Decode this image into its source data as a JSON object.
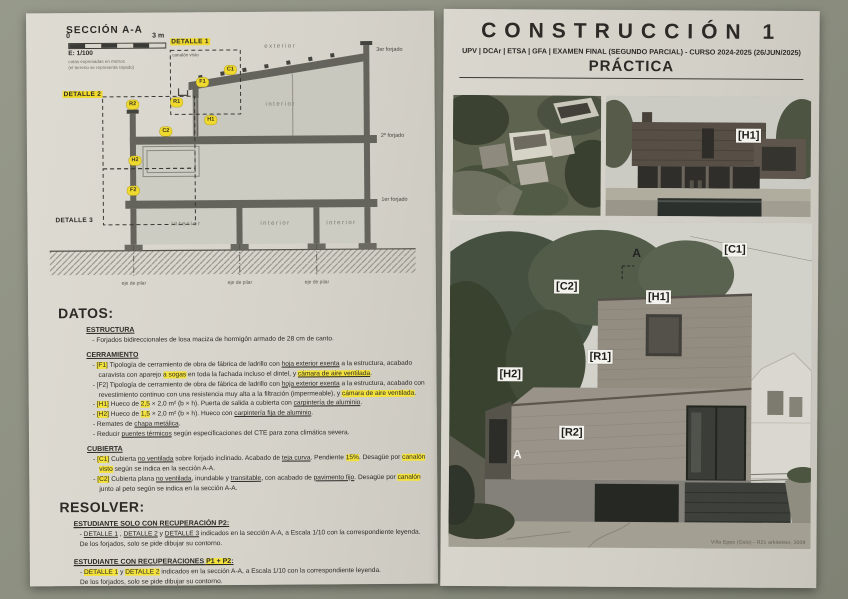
{
  "colors": {
    "highlight": "#f3e13c",
    "page": "#d6d3ca",
    "backdrop": "#8d9081"
  },
  "page_left": {
    "drawing": {
      "title": "SECCIÓN A-A",
      "scale": {
        "zero": "0",
        "end": "3 m",
        "ratio": "E: 1/100",
        "note1": "cotas expresadas en metros",
        "note2": "(el terreno se representa rayado)"
      },
      "detalle1": "DETALLE 1",
      "detalle2": "DETALLE 2",
      "detalle3": "DETALLE 3",
      "canalon_note": "canalón visto",
      "exterior_label": "exterior",
      "floor_labels": [
        {
          "label": "3er forjado",
          "x": 346,
          "y": 30,
          "name": "floor-label-3"
        },
        {
          "label": "2º forjado",
          "x": 350,
          "y": 116,
          "name": "floor-label-2"
        },
        {
          "label": "1er forjado",
          "x": 350,
          "y": 180,
          "name": "floor-label-1"
        }
      ],
      "axis_labels": [
        {
          "label": "eje de pilar",
          "x": 102,
          "y": 262,
          "name": "axis-label"
        },
        {
          "label": "eje de pilar",
          "x": 208,
          "y": 262,
          "name": "axis-label"
        },
        {
          "label": "eje de pilar",
          "x": 285,
          "y": 262,
          "name": "axis-label"
        }
      ],
      "room_labels": [
        {
          "label": "interior",
          "x": 155,
          "y": 203,
          "name": "room-label"
        },
        {
          "label": "interior",
          "x": 244,
          "y": 203,
          "name": "room-label"
        },
        {
          "label": "interior",
          "x": 310,
          "y": 203,
          "name": "room-label"
        },
        {
          "label": "interior",
          "x": 250,
          "y": 84,
          "name": "room-label"
        }
      ],
      "tags": [
        {
          "label": "C1",
          "x": 200,
          "y": 52,
          "name": "tag-c1"
        },
        {
          "label": "F1",
          "x": 172,
          "y": 64,
          "name": "tag-f1"
        },
        {
          "label": "R1",
          "x": 146,
          "y": 84,
          "name": "tag-r1"
        },
        {
          "label": "R2",
          "x": 102,
          "y": 86,
          "name": "tag-r2"
        },
        {
          "label": "C2",
          "x": 135,
          "y": 113,
          "name": "tag-c2"
        },
        {
          "label": "H1",
          "x": 180,
          "y": 102,
          "name": "tag-h1"
        },
        {
          "label": "H2",
          "x": 104,
          "y": 142,
          "name": "tag-h2"
        },
        {
          "label": "F2",
          "x": 102,
          "y": 172,
          "name": "tag-f2"
        }
      ]
    },
    "datos": {
      "heading": "DATOS:",
      "estructura_title": "ESTRUCTURA",
      "estructura": [
        [
          {
            "t": "- Forjados bidireccionales de losa maciza de hormigón armado de 28 cm de canto."
          }
        ]
      ],
      "cerramiento_title": "CERRAMIENTO",
      "cerramiento": [
        [
          {
            "t": "- "
          },
          {
            "t": "[F1]",
            "h": true
          },
          {
            "t": " Tipología de cerramiento de obra de fábrica de ladrillo con "
          },
          {
            "t": "hoja exterior exenta",
            "u": true
          },
          {
            "t": " a la estructura, acabado caravista con aparejo "
          },
          {
            "t": "a sogas",
            "h": true
          },
          {
            "t": " en toda la fachada incluso el dintel, y "
          },
          {
            "t": "cámara de aire ventilada",
            "h": true,
            "u": true
          },
          {
            "t": "."
          }
        ],
        [
          {
            "t": "- [F2] Tipología de cerramiento de obra de fábrica de ladrillo con "
          },
          {
            "t": "hoja exterior exenta",
            "u": true
          },
          {
            "t": " a la estructura, acabado con revestimiento continuo con una resistencia muy alta a la filtración (impermeable), y "
          },
          {
            "t": "cámara de aire ventilada",
            "h": true
          },
          {
            "t": "."
          }
        ],
        [
          {
            "t": "- "
          },
          {
            "t": "[H1]",
            "h": true
          },
          {
            "t": " Hueco de "
          },
          {
            "t": "2,5",
            "h": true
          },
          {
            "t": " × 2,0 m² (b × h). Puerta de salida a cubierta con "
          },
          {
            "t": "carpintería de aluminio",
            "u": true
          },
          {
            "t": "."
          }
        ],
        [
          {
            "t": "- "
          },
          {
            "t": "[H2]",
            "h": true
          },
          {
            "t": " Hueco de "
          },
          {
            "t": "1,5",
            "h": true
          },
          {
            "t": " × 2,0 m² (b × h). Hueco con "
          },
          {
            "t": "carpintería fija de aluminio",
            "u": true
          },
          {
            "t": "."
          }
        ],
        [
          {
            "t": "- Remates de "
          },
          {
            "t": "chapa metálica",
            "u": true
          },
          {
            "t": "."
          }
        ],
        [
          {
            "t": "- Reducir "
          },
          {
            "t": "puentes térmicos",
            "u": true
          },
          {
            "t": " según especificaciones del CTE para zona climática severa."
          }
        ]
      ],
      "cubierta_title": "CUBIERTA",
      "cubierta": [
        [
          {
            "t": "- "
          },
          {
            "t": "[C1]",
            "h": true
          },
          {
            "t": " Cubierta "
          },
          {
            "t": "no ventilada",
            "u": true
          },
          {
            "t": " sobre forjado inclinado. Acabado de "
          },
          {
            "t": "teja curva",
            "u": true
          },
          {
            "t": ". Pendiente "
          },
          {
            "t": "15%",
            "h": true
          },
          {
            "t": ". Desagüe por "
          },
          {
            "t": "canalón visto",
            "h": true
          },
          {
            "t": " según se indica en la sección A-A."
          }
        ],
        [
          {
            "t": "- "
          },
          {
            "t": "[C2]",
            "h": true
          },
          {
            "t": " Cubierta plana "
          },
          {
            "t": "no ventilada",
            "u": true
          },
          {
            "t": ", inundable y "
          },
          {
            "t": "transitable",
            "u": true
          },
          {
            "t": ", con acabado de "
          },
          {
            "t": "pavimento fijo",
            "u": true
          },
          {
            "t": ". Desagüe por "
          },
          {
            "t": "canalón",
            "h": true
          },
          {
            "t": " junto al peto según se indica en la sección A-A."
          }
        ]
      ]
    },
    "resolver": {
      "heading": "RESOLVER:",
      "group1_title": [
        {
          "t": "ESTUDIANTE SOLO CON RECUPERACIÓN P2:",
          "u": true
        }
      ],
      "group1_lines": [
        [
          {
            "t": "- "
          },
          {
            "t": "DETALLE 1",
            "u": true
          },
          {
            "t": " , "
          },
          {
            "t": "DETALLE 2",
            "u": true
          },
          {
            "t": " y "
          },
          {
            "t": "DETALLE 3",
            "u": true
          },
          {
            "t": " indicados en la sección A-A, a Escala 1/10 con la correspondiente leyenda."
          }
        ],
        [
          {
            "t": "De los forjados, solo se pide dibujar su contorno."
          }
        ]
      ],
      "group2_title": [
        {
          "t": "ESTUDIANTE CON RECUPERACIONES ",
          "u": true
        },
        {
          "t": "P1 + P2",
          "h": true,
          "u": true
        },
        {
          "t": ":",
          "u": true
        }
      ],
      "group2_lines": [
        [
          {
            "t": "- "
          },
          {
            "t": "DETALLE 1",
            "h": true
          },
          {
            "t": " y "
          },
          {
            "t": "DETALLE 2",
            "h": true
          },
          {
            "t": " indicados en la sección A-A, a Escala 1/10 con la correspondiente leyenda."
          }
        ],
        [
          {
            "t": "De los forjados, solo se pide dibujar su contorno."
          }
        ]
      ]
    }
  },
  "page_right": {
    "header": {
      "title": "CONSTRUCCIÓN 1",
      "subtitle": "UPV | DCAr | ETSA | GFA | EXAMEN FINAL (SEGUNDO PARCIAL) - CURSO 2024-2025 (26/JUN/2025)",
      "subject": "PRÁCTICA"
    },
    "photos": {
      "house_labels": [
        {
          "label": "[H1]",
          "x": 130,
          "y": 32,
          "variant": "",
          "name": "photo-label-h1"
        }
      ],
      "main_labels": [
        {
          "label": "[C1]",
          "x": 272,
          "y": 20,
          "variant": "",
          "name": "photo-label-c1"
        },
        {
          "label": "A",
          "x": 180,
          "y": 24,
          "variant": "dark-a",
          "name": "section-mark-a-top"
        },
        {
          "label": "[C2]",
          "x": 104,
          "y": 58,
          "variant": "",
          "name": "photo-label-c2"
        },
        {
          "label": "[H1]",
          "x": 196,
          "y": 68,
          "variant": "",
          "name": "photo-label-h1"
        },
        {
          "label": "[R1]",
          "x": 138,
          "y": 128,
          "variant": "",
          "name": "photo-label-r1"
        },
        {
          "label": "[H2]",
          "x": 48,
          "y": 146,
          "variant": "",
          "name": "photo-label-h2"
        },
        {
          "label": "[R2]",
          "x": 110,
          "y": 204,
          "variant": "",
          "name": "photo-label-r2"
        },
        {
          "label": "A",
          "x": 62,
          "y": 226,
          "variant": "white-a",
          "name": "section-mark-a-bottom"
        }
      ],
      "caption": "Villa Eppe (Oslo) - R21 arkitekter, 2009"
    }
  }
}
